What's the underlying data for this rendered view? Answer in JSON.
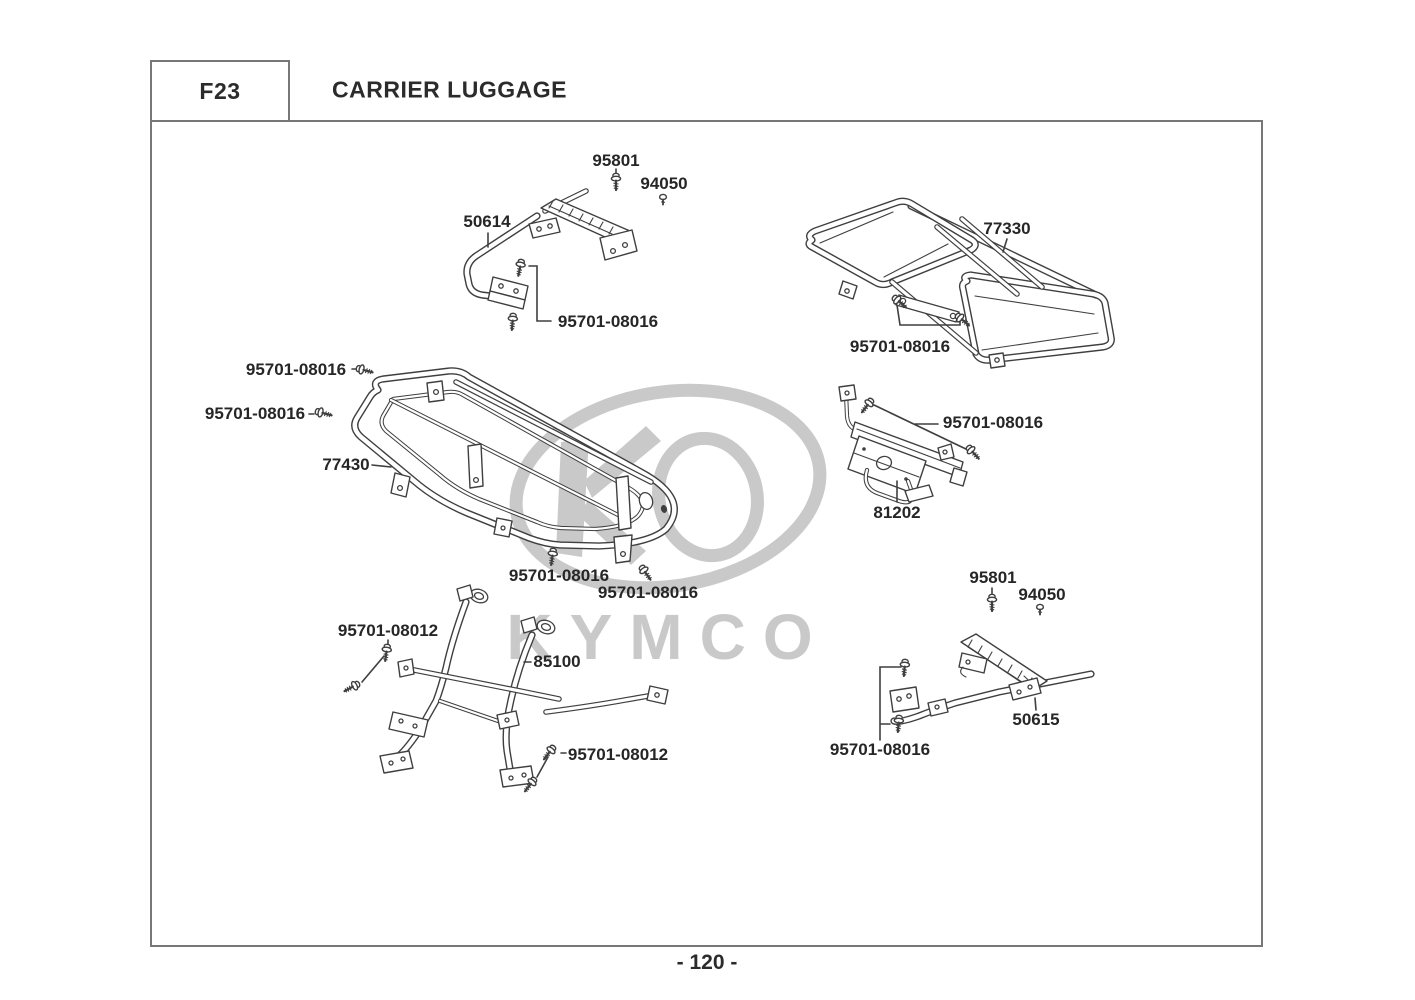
{
  "page": {
    "section_code": "F23",
    "title": "CARRIER LUGGAGE",
    "page_number": "- 120 -",
    "watermark_brand": "KYMCO"
  },
  "colors": {
    "drawing_line": "#3f3f3f",
    "label_text": "#262626",
    "border": "#777777",
    "watermark": "#c9c9c9"
  },
  "assemblies": {
    "front_footrest_bar": {
      "part": "50614",
      "pan_screw": "95801",
      "nut": "94050",
      "flange_bolt": "95701-08016"
    },
    "rear_carrier_rack": {
      "part": "77330",
      "flange_bolt": "95701-08016"
    },
    "front_carrier_frame": {
      "part": "77430",
      "flange_bolt_upper_left": "95701-08016",
      "flange_bolt_lower_left": "95701-08016",
      "flange_bolt_bottom_left": "95701-08016",
      "flange_bolt_bottom_right": "95701-08016"
    },
    "rear_bracket": {
      "part": "81202",
      "flange_bolt": "95701-08016"
    },
    "front_guard_pipe": {
      "part": "85100",
      "flange_bolt_left": "95701-08012",
      "flange_bolt_bottom": "95701-08012"
    },
    "rear_footrest_bar": {
      "part": "50615",
      "pan_screw": "95801",
      "nut": "94050",
      "flange_bolt": "95701-08016"
    }
  }
}
